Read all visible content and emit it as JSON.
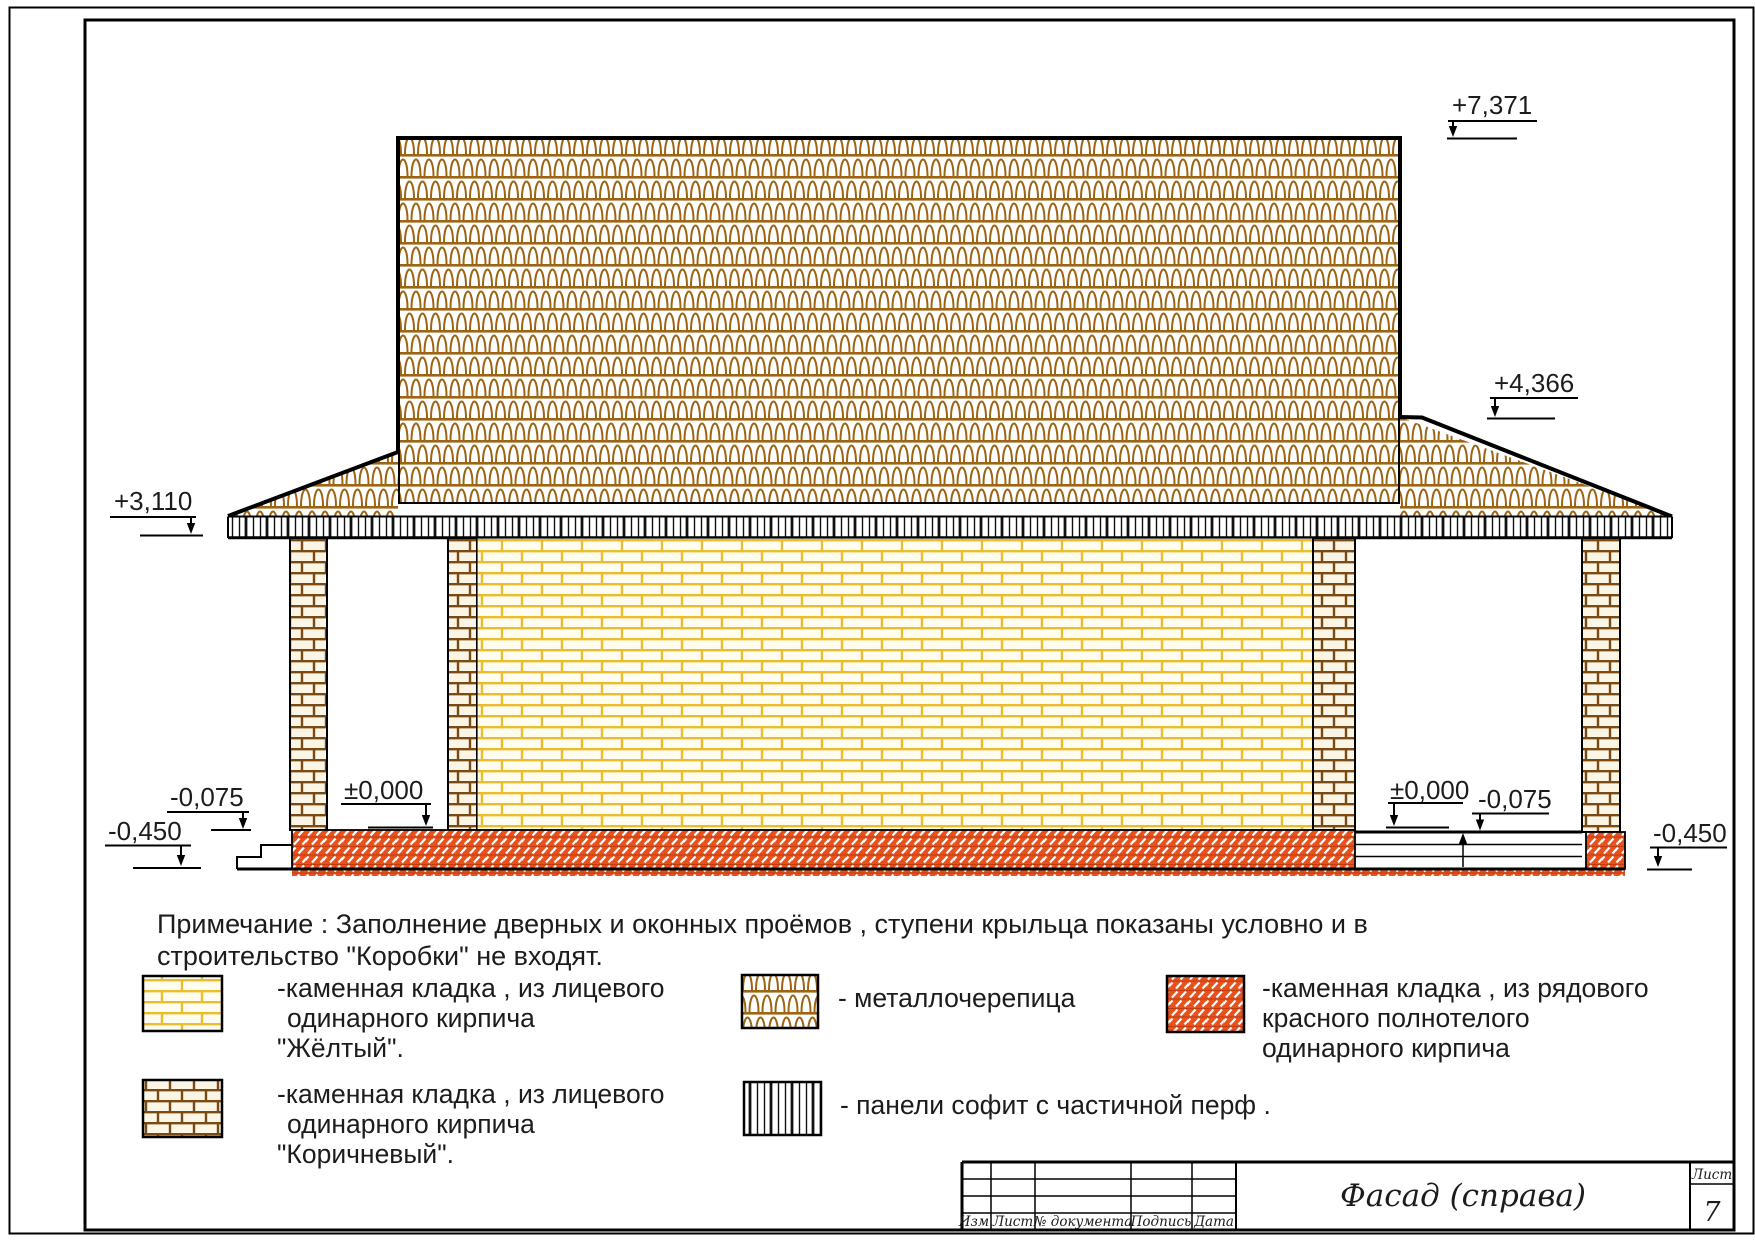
{
  "sheet": {
    "marks": {
      "ridge": "+7,371",
      "right_roof": "+4,366",
      "left_eaves": "+3,110",
      "zero_left": "±0,000",
      "zero_right": "±0,000",
      "minus075_left": "-0,075",
      "minus075_right": "-0,075",
      "minus450_left": "-0,450",
      "minus450_right": "-0,450"
    },
    "note": {
      "line1": "Примечание : Заполнение дверных и оконных проёмов , ступени крыльца показаны условно и в",
      "line2": "строительство  \"Коробки\" не входят."
    },
    "legend": {
      "yellow_brick": {
        "line1": "-каменная кладка , из лицевого",
        "line2": "одинарного кирпича",
        "line3": "\"Жёлтый\"."
      },
      "brown_brick": {
        "line1": "-каменная кладка , из лицевого",
        "line2": "одинарного кирпича",
        "line3": "\"Коричневый\"."
      },
      "metal_tile": {
        "line1": "- металлочерепица"
      },
      "soffit": {
        "line1": "- панели софит с частичной перф ."
      },
      "red_brick": {
        "line1": "-каменная кладка , из рядового",
        "line2": "красного полнотелого",
        "line3": "одинарного кирпича"
      }
    },
    "title_block": {
      "col_izm": "Изм.",
      "col_list": "Лист",
      "col_doc": "№ документа",
      "col_sign": "Подпись",
      "col_date": "Дата",
      "title": "Фасад (справа)",
      "sheet_label": "Лист",
      "sheet_number": "7"
    },
    "colors": {
      "roof_tile_brown": "#9c6413",
      "yellow_brick_joint": "#eabd2c",
      "brown_brick_joint": "#7a4a12",
      "red_plinth": "#e8501c"
    }
  }
}
